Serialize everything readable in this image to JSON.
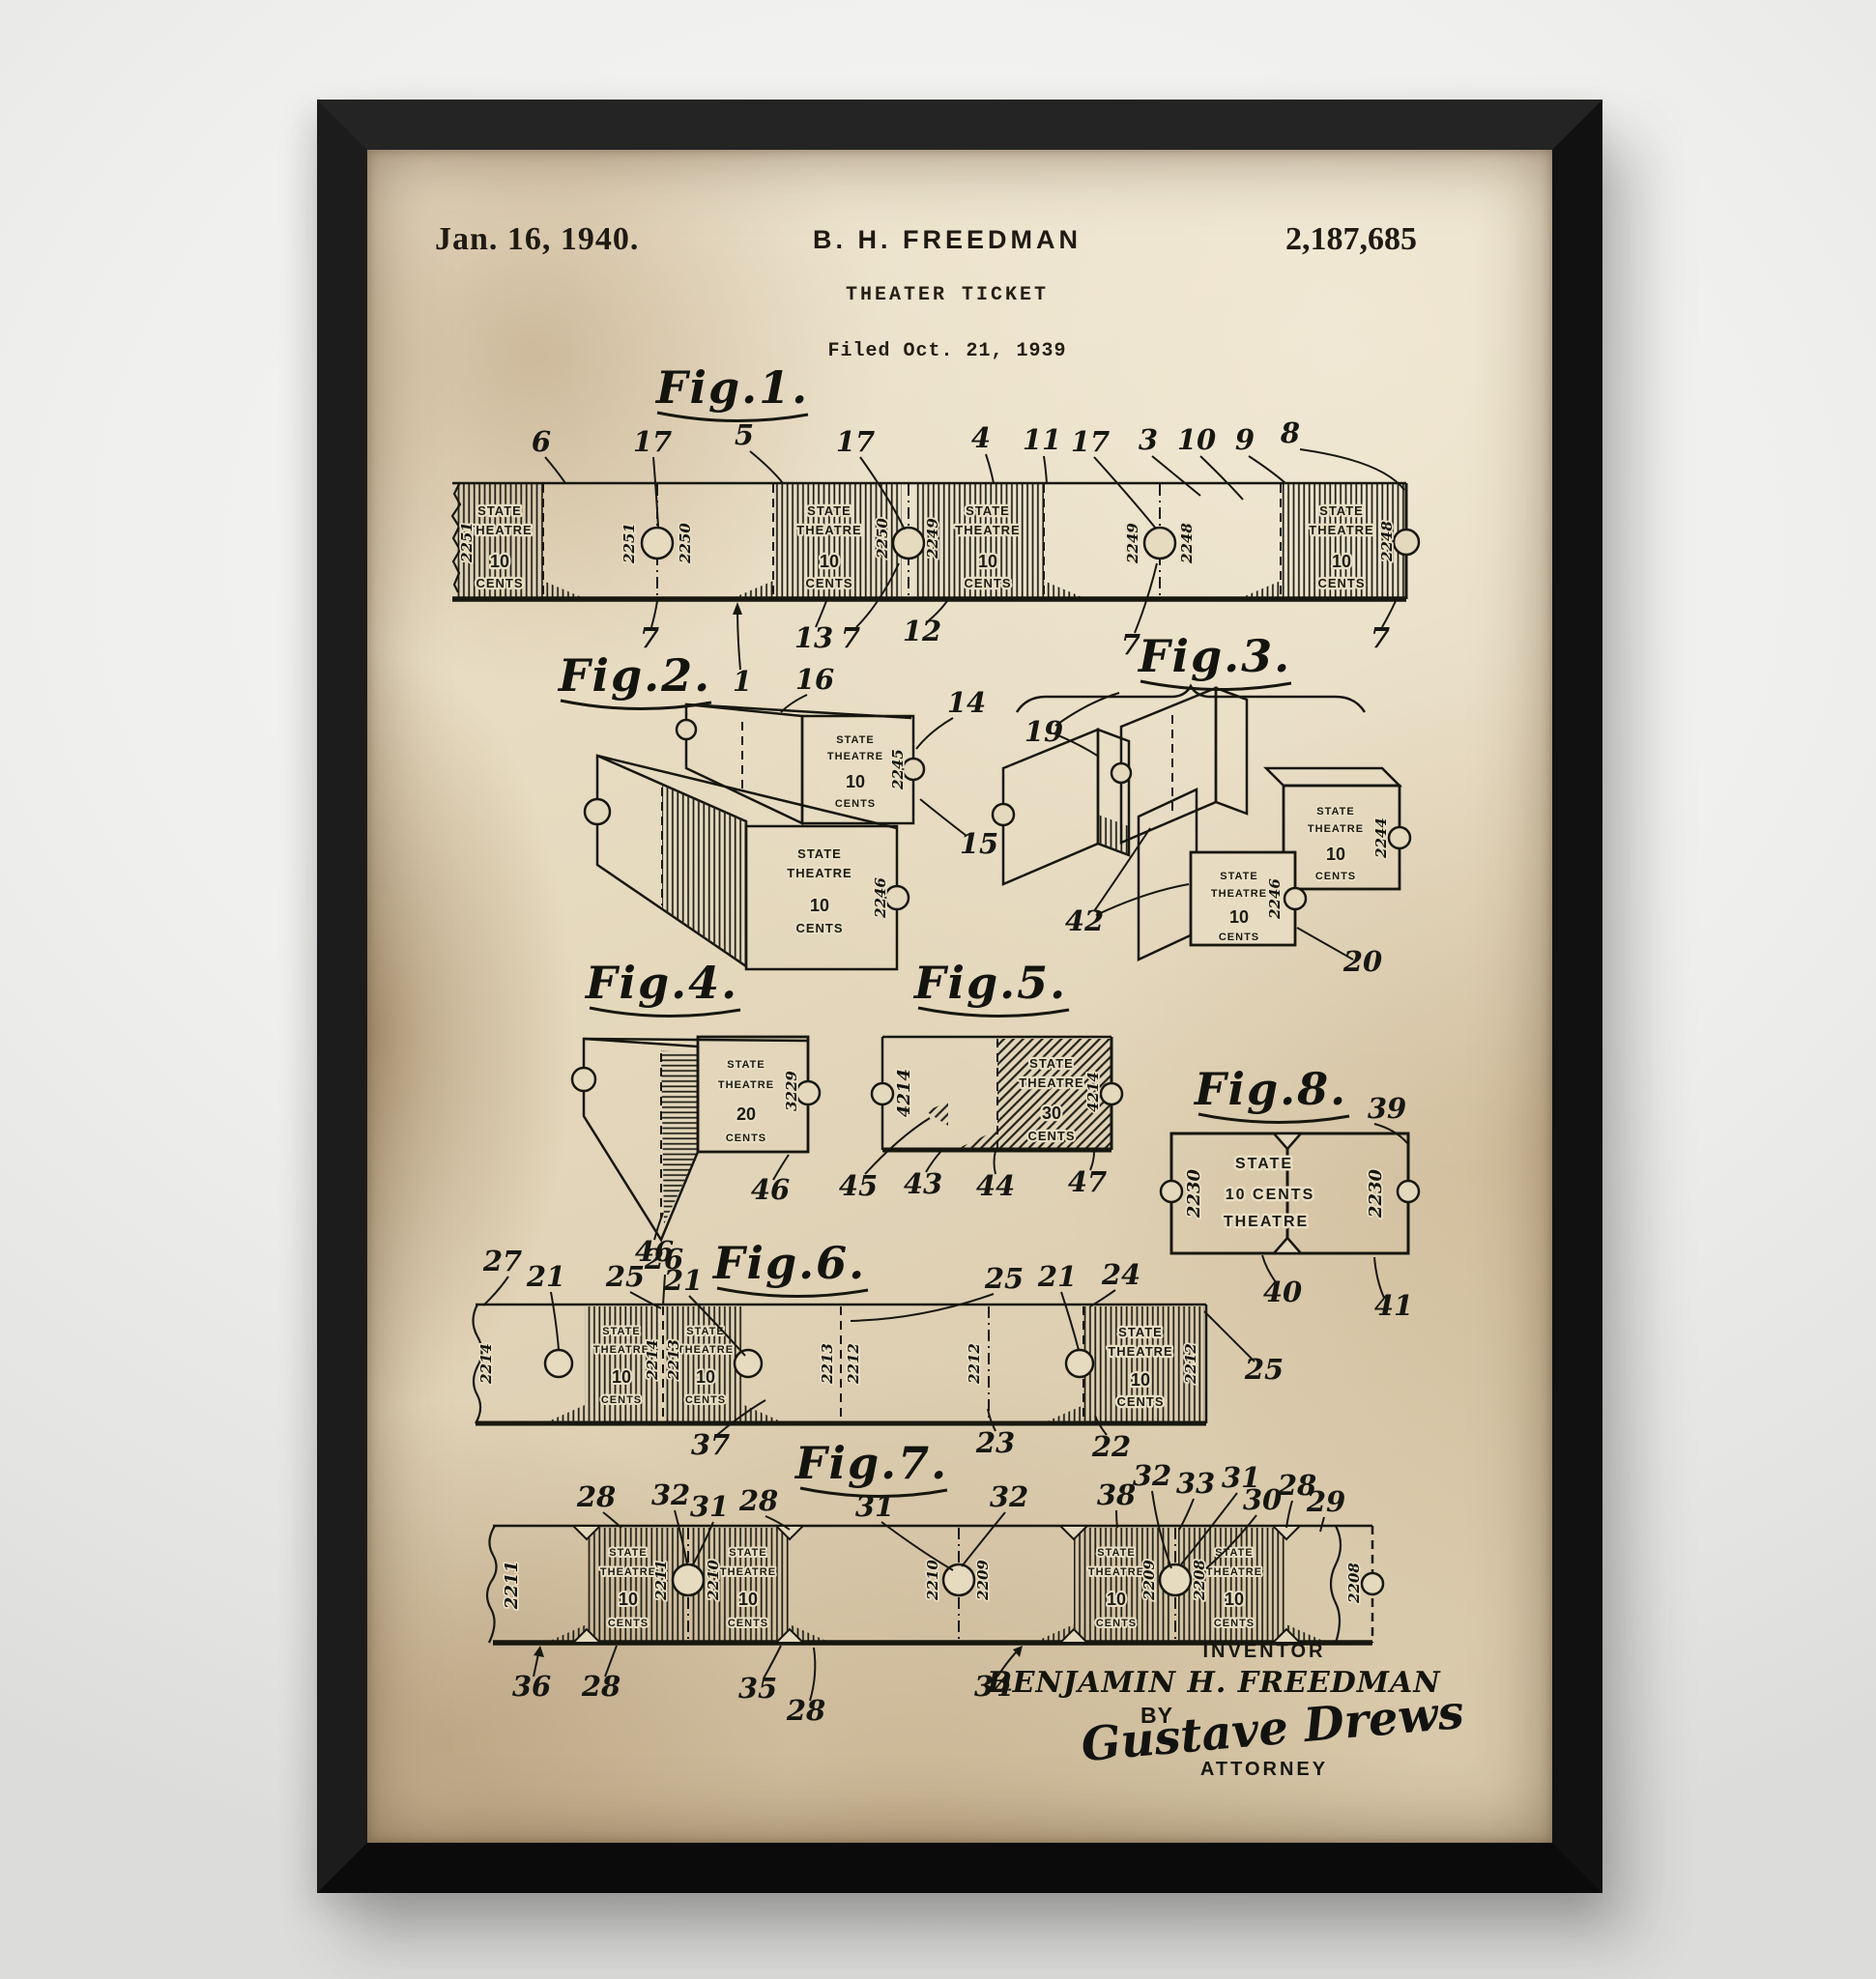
{
  "palette": {
    "wall": "#efefed",
    "frame": "#161616",
    "paper": "#e4d8bd",
    "ink": "#17170f"
  },
  "header": {
    "date": "Jan. 16, 1940.",
    "inventor": "B. H. FREEDMAN",
    "doc_title": "THEATER TICKET",
    "filed": "Filed Oct. 21, 1939",
    "patent_number": "2,187,685"
  },
  "ticket_face": {
    "state": "STATE",
    "theatre": "THEATRE",
    "cents": "CENTS",
    "price_10": "10",
    "price_20": "20",
    "price_30": "30",
    "fig8_price": "10 CENTS"
  },
  "serials": {
    "n2251": "2251",
    "n2250": "2250",
    "n2249": "2249",
    "n2248": "2248",
    "n2246": "2246",
    "n2245": "2245",
    "n2244": "2244",
    "n3229": "3229",
    "n4214": "4214",
    "n2230": "2230",
    "n2214": "2214",
    "n2213": "2213",
    "n2212": "2212",
    "n2211": "2211",
    "n2210": "2210",
    "n2209": "2209",
    "n2208": "2208"
  },
  "figures": {
    "fig1": {
      "label": "Fig.1.",
      "callouts_top": [
        "6",
        "17",
        "5",
        "17",
        "4",
        "11",
        "17",
        "3",
        "10",
        "9",
        "8"
      ],
      "callouts_bottom": [
        "7",
        "1",
        "13",
        "7",
        "12",
        "7",
        "7"
      ]
    },
    "fig2": {
      "label": "Fig.2.",
      "callouts": [
        "16",
        "14",
        "15"
      ]
    },
    "fig3": {
      "label": "Fig.3.",
      "callouts": [
        "19",
        "42",
        "20"
      ]
    },
    "fig4": {
      "label": "Fig.4.",
      "callouts": [
        "46",
        "46"
      ]
    },
    "fig5": {
      "label": "Fig.5.",
      "callouts": [
        "45",
        "43",
        "44",
        "47"
      ]
    },
    "fig6": {
      "label": "Fig.6.",
      "callouts_top": [
        "27",
        "21",
        "25",
        "26",
        "21",
        "25",
        "21",
        "24"
      ],
      "callouts_bottom": [
        "37",
        "23",
        "22"
      ],
      "callout_right": "25"
    },
    "fig7": {
      "label": "Fig.7.",
      "callouts_top": [
        "28",
        "32",
        "31",
        "28",
        "31",
        "32",
        "38",
        "32",
        "33",
        "31",
        "30",
        "28",
        "29"
      ],
      "callouts_bottom": [
        "36",
        "28",
        "35",
        "28",
        "34"
      ]
    },
    "fig8": {
      "label": "Fig.8.",
      "callouts": [
        "39",
        "40",
        "41"
      ]
    }
  },
  "footer": {
    "inventor_label": "INVENTOR",
    "inventor_name": "BENJAMIN H. FREEDMAN",
    "by_label": "BY",
    "signature": "Gustave Drews",
    "attorney_label": "ATTORNEY"
  }
}
